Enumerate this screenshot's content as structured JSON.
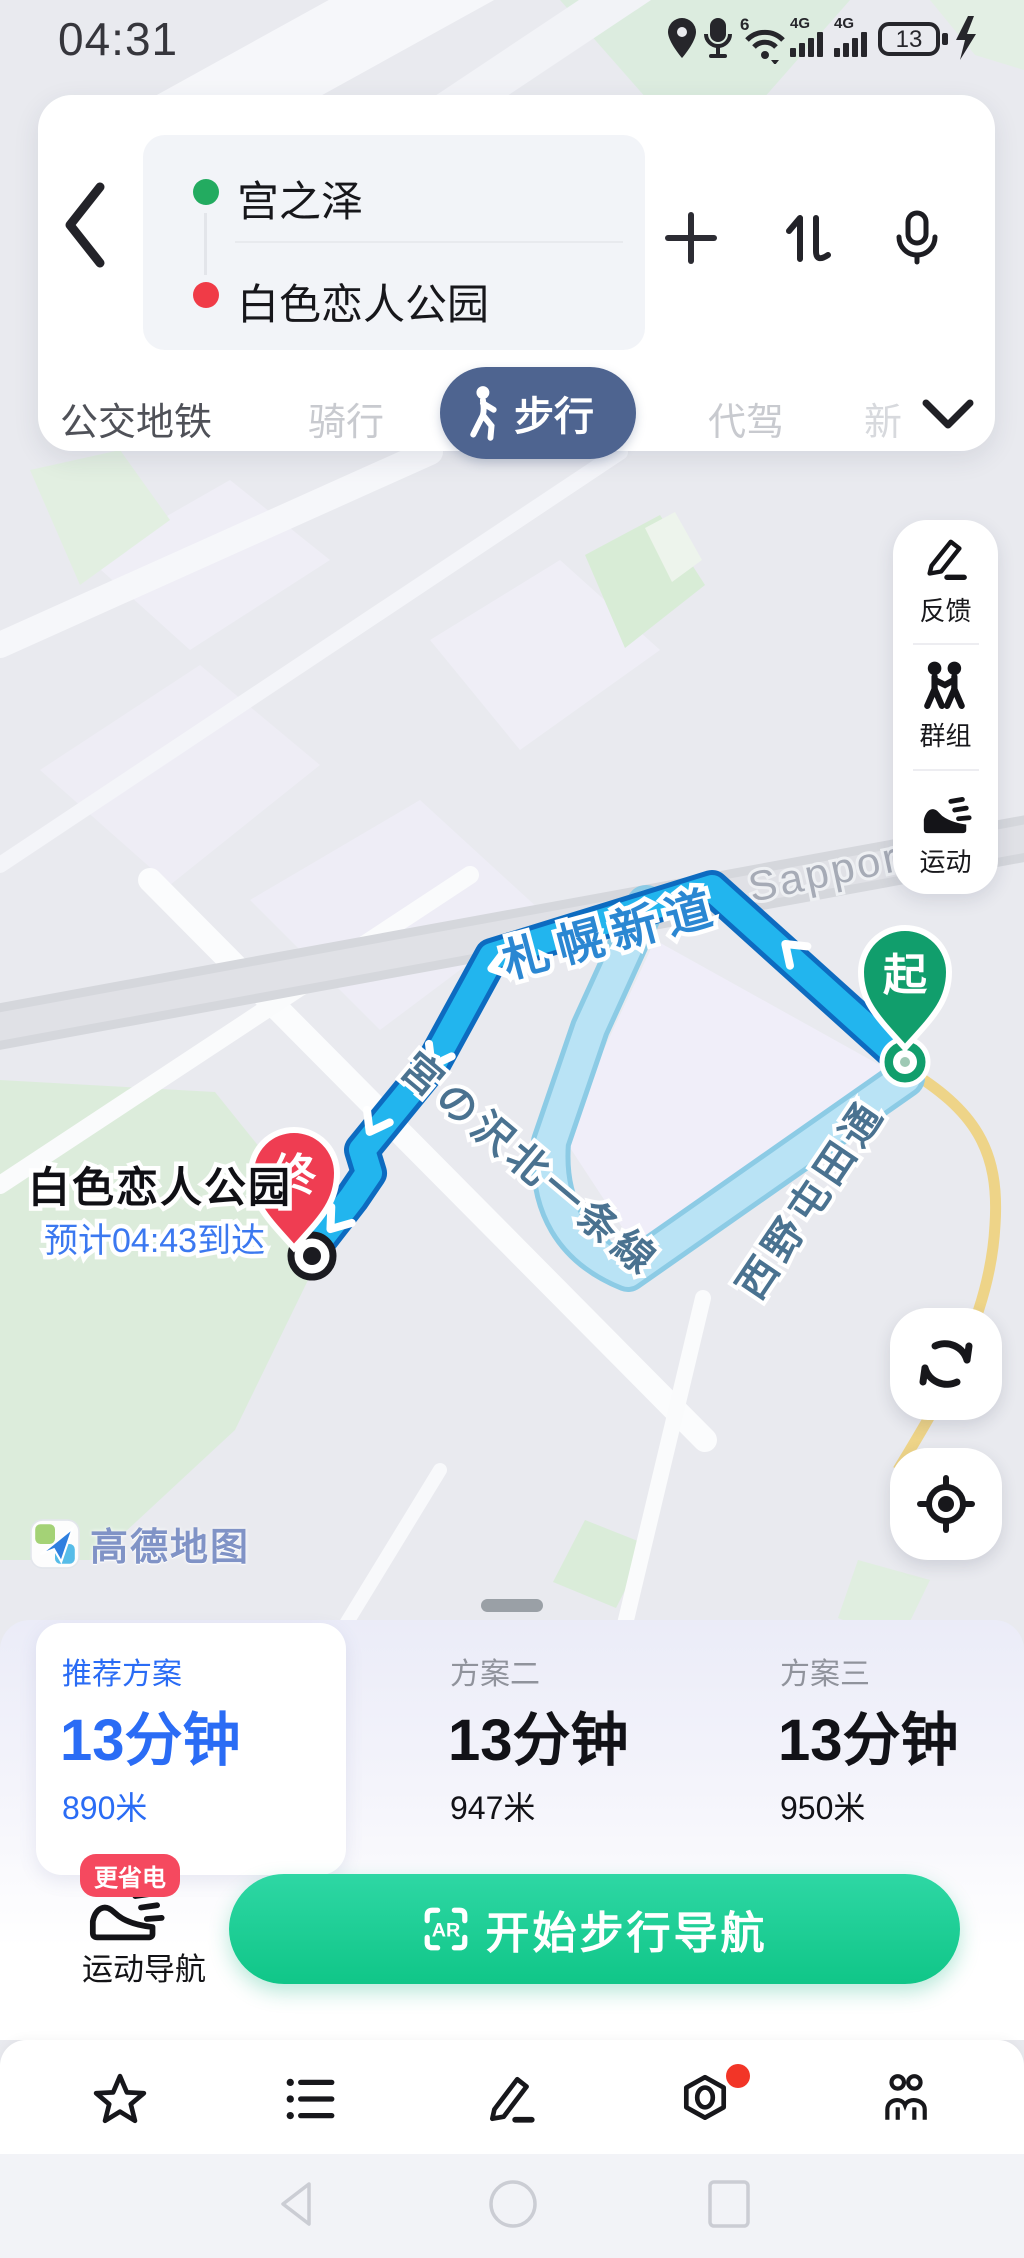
{
  "status_bar": {
    "time": "04:31",
    "battery_level": "13"
  },
  "route_form": {
    "origin": "宫之泽",
    "destination": "白色恋人公园"
  },
  "mode_tabs": {
    "transit": "公交地铁",
    "cycling": "骑行",
    "walking": "步行",
    "chauffeur": "代驾",
    "more_partial": "新"
  },
  "map_tools": {
    "feedback": "反馈",
    "group": "群组",
    "sport": "运动"
  },
  "map": {
    "road_sapporo_shindo": "札幌新道",
    "road_sapporo_en": "Sapporo",
    "road_miyanosawa": "宮の沢北一条線",
    "road_nishino": "西野屯田通",
    "start_pin": "起",
    "end_pin": "终",
    "destination_name": "白色恋人公园",
    "eta": "预计04:43到达",
    "logo_text": "高德地图"
  },
  "plans": {
    "recommended": {
      "label": "推荐方案",
      "duration": "13分钟",
      "distance": "890米"
    },
    "plan2": {
      "label": "方案二",
      "duration": "13分钟",
      "distance": "947米"
    },
    "plan3": {
      "label": "方案三",
      "duration": "13分钟",
      "distance": "950米"
    }
  },
  "sport_nav": {
    "badge": "更省电",
    "label": "运动导航"
  },
  "start_nav": {
    "ar": "AR",
    "label": "开始步行导航"
  },
  "colors": {
    "accent_blue": "#2a6cf5",
    "route_blue": "#22b5ee",
    "alt_route_blue": "#b9e3f5",
    "brand_green": "#12c78a",
    "walk_pill_slate": "#4e6490",
    "alert_red": "#f5495f",
    "start_green": "#119e6c",
    "end_red": "#ef3d52"
  }
}
